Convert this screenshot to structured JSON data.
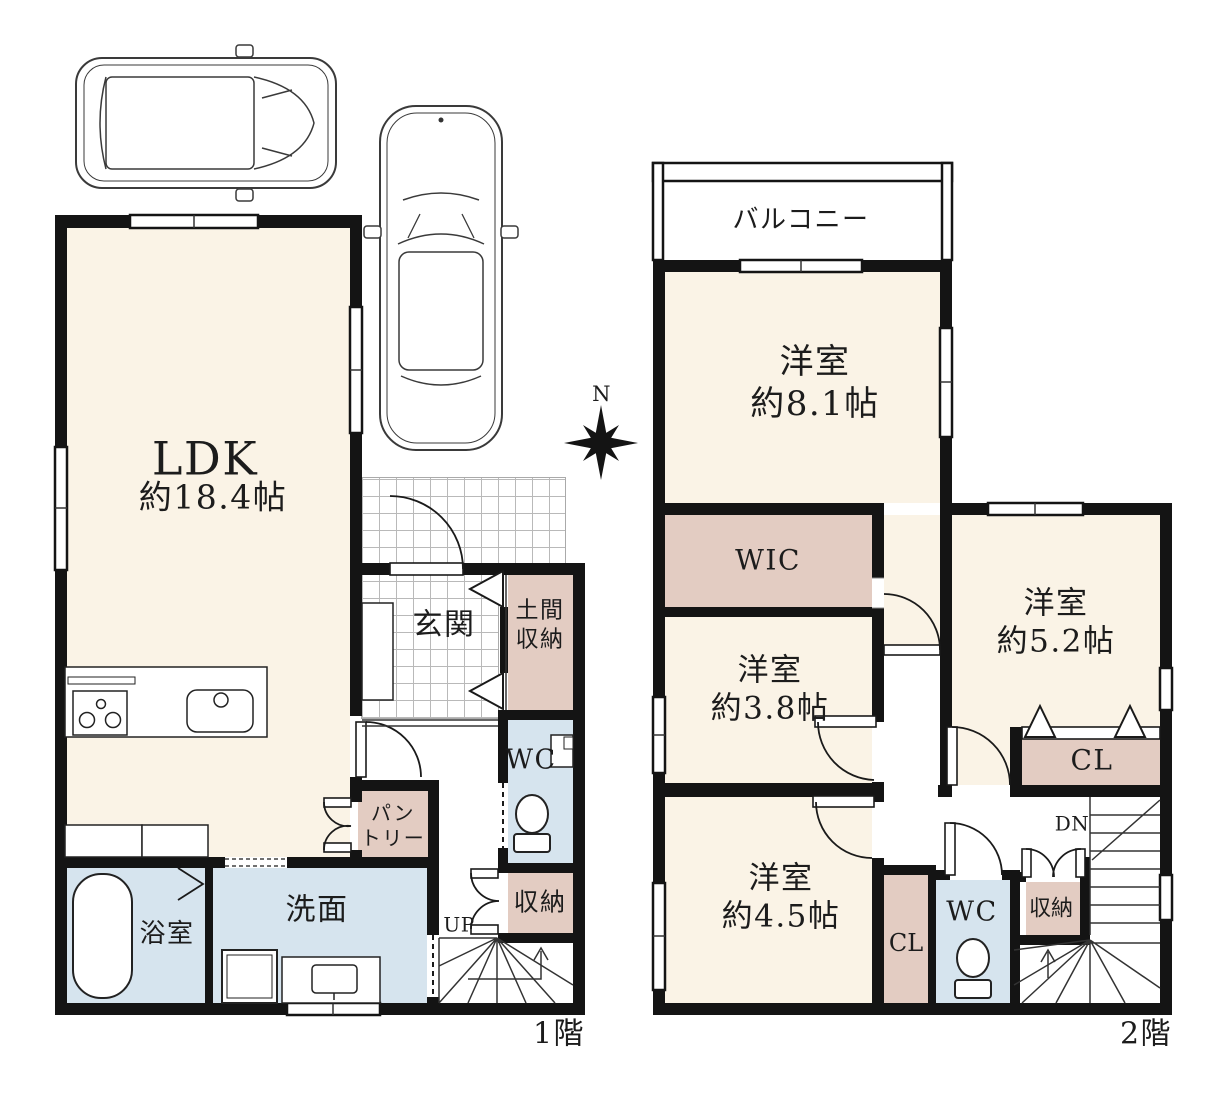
{
  "compass": {
    "north": "N"
  },
  "floor1": {
    "floor_label": "1階",
    "ldk_title": "LDK",
    "ldk_size": "約18.4帖",
    "genkan": "玄関",
    "doma_storage": "土間\n収納",
    "wc": "WC",
    "pantry": "パン\nトリー",
    "storage": "収納",
    "stairs_up": "UP",
    "bath": "浴室",
    "washroom": "洗面"
  },
  "floor2": {
    "floor_label": "2階",
    "balcony": "バルコニー",
    "room_8_1": "洋室\n約8.1帖",
    "wic": "WIC",
    "room_3_8": "洋室\n約3.8帖",
    "room_5_2": "洋室\n約5.2帖",
    "closet_main": "CL",
    "room_4_5": "洋室\n約4.5帖",
    "closet_small": "CL",
    "wc": "WC",
    "storage": "収納",
    "stairs_down": "DN"
  },
  "colors": {
    "room_cream": "#faf3e6",
    "storage_pink": "#e3ccc2",
    "water_blue": "#d6e4ee",
    "wall": "#141414"
  }
}
